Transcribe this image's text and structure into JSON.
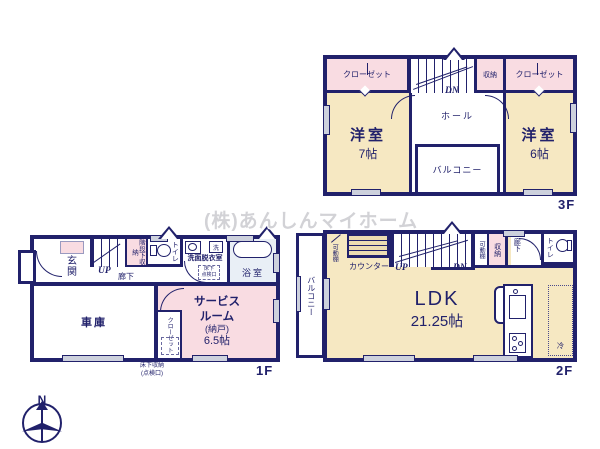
{
  "watermark": {
    "text": "(株)あんしんマイホーム"
  },
  "compass": {
    "north_label": "N"
  },
  "floor3": {
    "tag": "3F",
    "closet_left": "クローゼット",
    "storage": "収納",
    "closet_right": "クローゼット",
    "stairs_dn": "DN",
    "room_left_name": "洋室",
    "room_left_size": "7帖",
    "hall": "ホール",
    "room_right_name": "洋室",
    "room_right_size": "6帖",
    "balcony": "バルコニー"
  },
  "floor1": {
    "tag": "1F",
    "entrance": "玄関",
    "stairs_up": "UP",
    "under_stairs_storage": "階段下収納",
    "hallway": "廊下",
    "toilet": "トイレ",
    "washroom": "洗面脱衣室",
    "washer": "洗",
    "inspection_hatch_line1": "床下",
    "inspection_hatch_line2": "点検口",
    "bathroom": "浴室",
    "garage": "車庫",
    "service_room_line1": "サービス",
    "service_room_line2": "ルーム",
    "service_room_line3": "(納戸)",
    "service_room_size": "6.5帖",
    "closet": "クローゼット",
    "underfloor_storage_line1": "床下収納",
    "underfloor_storage_line2": "(点検口)"
  },
  "floor2": {
    "tag": "2F",
    "balcony": "バルコニー",
    "movable_shelf_left": "可動棚",
    "counter": "カウンター",
    "stairs_up": "UP",
    "stairs_dn": "DN",
    "movable_shelf_right": "可動棚",
    "storage": "収納",
    "hallway": "廊下",
    "toilet": "トイレ",
    "ldk_name": "LDK",
    "ldk_size": "21.25帖",
    "fridge": "冷"
  }
}
